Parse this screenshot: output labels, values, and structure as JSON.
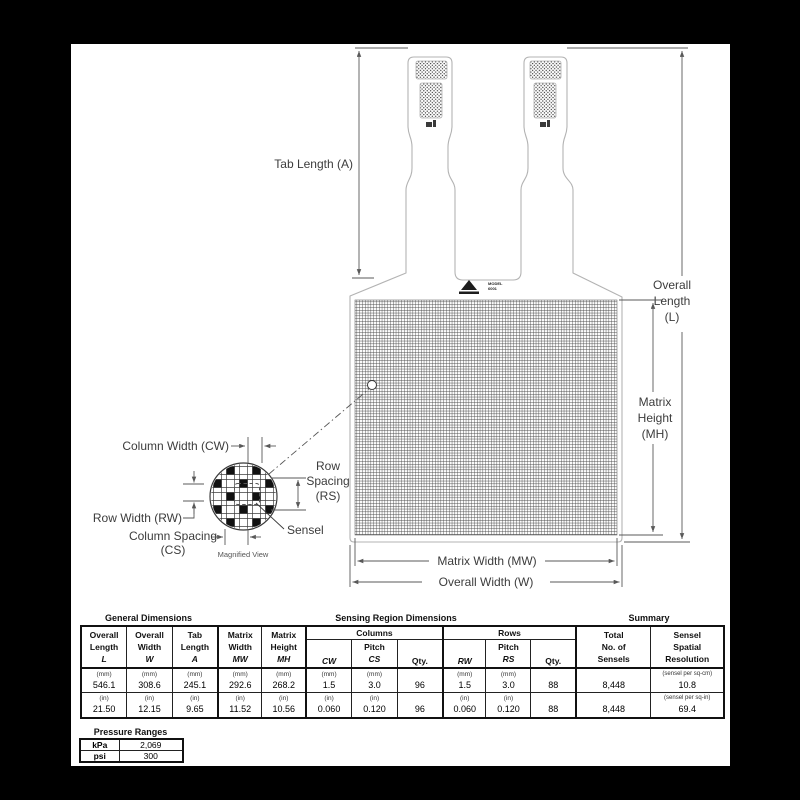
{
  "diagram": {
    "tab_length_label": "Tab Length (A)",
    "overall_length": {
      "l1": "Overall",
      "l2": "Length",
      "l3": "(L)"
    },
    "matrix_height": {
      "l1": "Matrix",
      "l2": "Height",
      "l3": "(MH)"
    },
    "matrix_width_label": "Matrix Width (MW)",
    "overall_width_label": "Overall Width (W)",
    "column_width_label": "Column Width (CW)",
    "row_spacing": {
      "l1": "Row",
      "l2": "Spacing",
      "l3": "(RS)"
    },
    "row_width_label": "Row Width (RW)",
    "column_spacing": {
      "l1": "Column Spacing",
      "l2": "(CS)"
    },
    "sensel_label": "Sensel",
    "magnified_view_label": "Magnified View",
    "model": {
      "l1": "MODEL",
      "l2": "6001"
    }
  },
  "table": {
    "titles": {
      "general": "General Dimensions",
      "sensing": "Sensing Region Dimensions",
      "summary": "Summary"
    },
    "headers": {
      "overall_length": {
        "l1": "Overall",
        "l2": "Length",
        "l3": "L"
      },
      "overall_width": {
        "l1": "Overall",
        "l2": "Width",
        "l3": "W"
      },
      "tab_length": {
        "l1": "Tab",
        "l2": "Length",
        "l3": "A"
      },
      "matrix_width": {
        "l1": "Matrix",
        "l2": "Width",
        "l3": "MW"
      },
      "matrix_height": {
        "l1": "Matrix",
        "l2": "Height",
        "l3": "MH"
      },
      "columns_group": "Columns",
      "rows_group": "Rows",
      "cw": "CW",
      "pitch": "Pitch",
      "cs": "CS",
      "qty": "Qty.",
      "rw": "RW",
      "rs": "RS",
      "total": {
        "l1": "Total",
        "l2": "No. of",
        "l3": "Sensels"
      },
      "resolution": {
        "l1": "Sensel",
        "l2": "Spatial",
        "l3": "Resolution"
      }
    },
    "metric": {
      "unit": "(mm)",
      "l": "546.1",
      "w": "308.6",
      "a": "245.1",
      "mw": "292.6",
      "mh": "268.2",
      "cw": "1.5",
      "cs": "3.0",
      "qty_cols": "96",
      "rw": "1.5",
      "rs": "3.0",
      "qty_rows": "88",
      "total": "8,448",
      "res_unit": "(sensel per sq-cm)",
      "res": "10.8"
    },
    "imperial": {
      "unit": "(in)",
      "l": "21.50",
      "w": "12.15",
      "a": "9.65",
      "mw": "11.52",
      "mh": "10.56",
      "cw": "0.060",
      "cs": "0.120",
      "qty_cols": "96",
      "rw": "0.060",
      "rs": "0.120",
      "qty_rows": "88",
      "total": "8,448",
      "res_unit": "(sensel per sq-in)",
      "res": "69.4"
    }
  },
  "pressure": {
    "title": "Pressure Ranges",
    "kpa_label": "kPa",
    "kpa_value": "2,069",
    "psi_label": "psi",
    "psi_value": "300"
  }
}
